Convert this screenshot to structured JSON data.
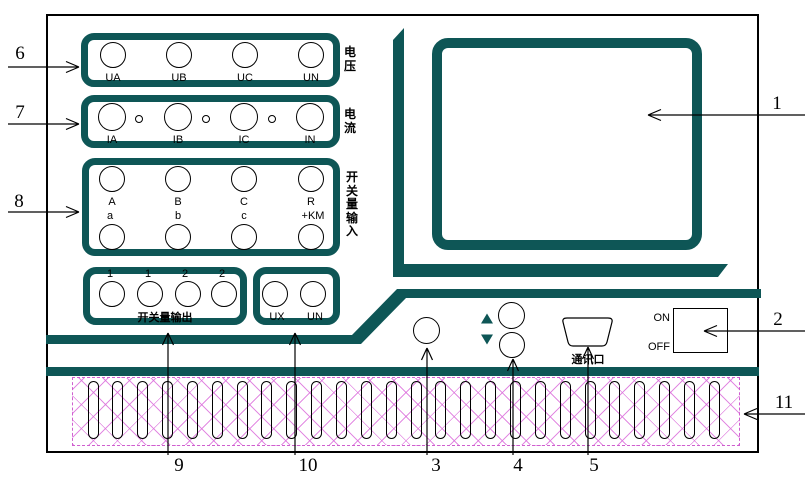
{
  "title": "instrument-front-panel-diagram",
  "colors": {
    "teal": "#0e5656",
    "hatch_magenta": "#cf5fcf",
    "line_black": "#000000"
  },
  "groups": {
    "voltage": {
      "side_label": "电压",
      "terminals": [
        {
          "label": "UA"
        },
        {
          "label": "UB"
        },
        {
          "label": "UC"
        },
        {
          "label": "UN"
        }
      ]
    },
    "current": {
      "side_label": "电流",
      "terminals": [
        {
          "label": "IA"
        },
        {
          "label": "IB"
        },
        {
          "label": "IC"
        },
        {
          "label": "IN"
        }
      ]
    },
    "switch_input": {
      "side_label": "开关量输入",
      "columns": [
        {
          "top": "A",
          "bottom": "a"
        },
        {
          "top": "B",
          "bottom": "b"
        },
        {
          "top": "C",
          "bottom": "c"
        },
        {
          "top": "R",
          "bottom": "+KM"
        }
      ]
    },
    "switch_output": {
      "title": "开关量输出",
      "channels": [
        {
          "label": "1"
        },
        {
          "label": "1"
        },
        {
          "label": "2"
        },
        {
          "label": "2"
        }
      ]
    },
    "aux_voltage": {
      "terminals": [
        {
          "label": "UX"
        },
        {
          "label": "UN"
        }
      ]
    }
  },
  "controls": {
    "power_switch": {
      "on_label": "ON",
      "off_label": "OFF"
    },
    "comm_port_label": "通讯口"
  },
  "callouts": {
    "c1": "1",
    "c2": "2",
    "c3": "3",
    "c4": "4",
    "c5": "5",
    "c6": "6",
    "c7": "7",
    "c8": "8",
    "c9": "9",
    "c10": "10",
    "c11": "11"
  },
  "grille": {
    "slot_count": 26
  }
}
